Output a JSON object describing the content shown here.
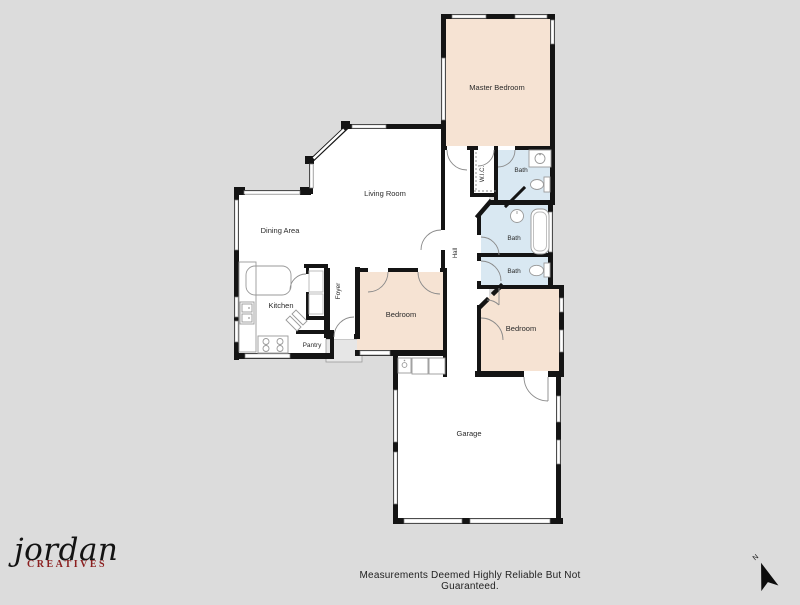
{
  "floorplan": {
    "colors": {
      "background": "#dcdcdc",
      "room": "#ffffff",
      "bedroom": "#f6e3d3",
      "bath": "#d9e8f2",
      "wall": "#141414",
      "stoop": "#e6e6e6",
      "fixture": "#999999",
      "logo_accent": "#8b1f1f"
    },
    "rooms": [
      {
        "id": "master-bedroom",
        "label": "Master Bedroom"
      },
      {
        "id": "living-room",
        "label": "Living Room"
      },
      {
        "id": "dining-area",
        "label": "Dining Area"
      },
      {
        "id": "kitchen",
        "label": "Kitchen"
      },
      {
        "id": "pantry",
        "label": "Pantry"
      },
      {
        "id": "foyer",
        "label": "Foyer"
      },
      {
        "id": "hall",
        "label": "Hall"
      },
      {
        "id": "wic",
        "label": "W.I.C."
      },
      {
        "id": "bath-master",
        "label": "Bath"
      },
      {
        "id": "bath-hall",
        "label": "Bath"
      },
      {
        "id": "bath-guest",
        "label": "Bath"
      },
      {
        "id": "bedroom-middle",
        "label": "Bedroom"
      },
      {
        "id": "bedroom-rear",
        "label": "Bedroom"
      },
      {
        "id": "garage",
        "label": "Garage"
      }
    ]
  },
  "compass": {
    "label": "N"
  },
  "footer": {
    "brand_name": "jordan",
    "brand_subtitle": "CREATIVES",
    "disclaimer": "Measurements Deemed Highly Reliable But Not Guaranteed."
  }
}
